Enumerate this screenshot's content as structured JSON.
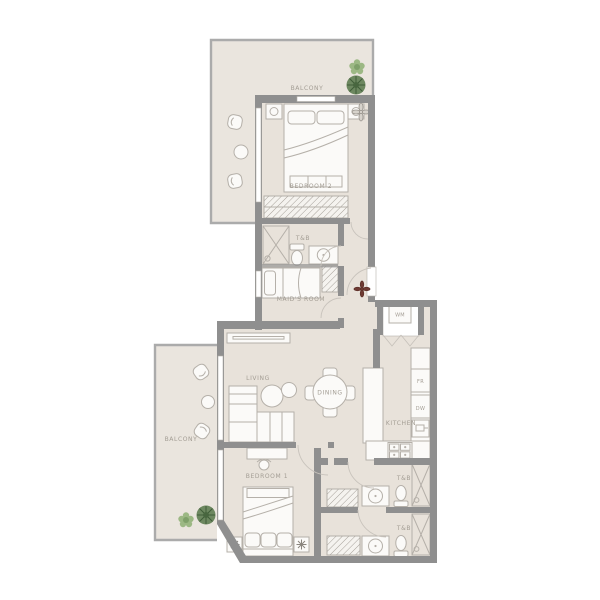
{
  "floor_plan": {
    "upper": {
      "balcony": "BALCONY",
      "bedroom2": "BEDROOM 2",
      "tb": "T&B",
      "maids_room": "MAID'S ROOM"
    },
    "utility": {
      "wm": "WM"
    },
    "main": {
      "living": "LIVING",
      "dining": "DINING",
      "kitchen": "KITCHEN",
      "fridge": "FR",
      "dishwasher": "DW",
      "balcony": "BALCONY"
    },
    "lower": {
      "bedroom1": "BEDROOM 1",
      "tb1": "T&B",
      "tb2": "T&B"
    }
  },
  "colors": {
    "floor": "#e8e2da",
    "balcony_floor": "#eae5de",
    "wall": "#8f8f8f",
    "furniture_fill": "#fbfaf8",
    "outline": "#b5b0a9",
    "label": "#a39d94",
    "plant_dark": "#5f7d52",
    "plant_light": "#9cb884",
    "accent": "#6e3a32"
  }
}
